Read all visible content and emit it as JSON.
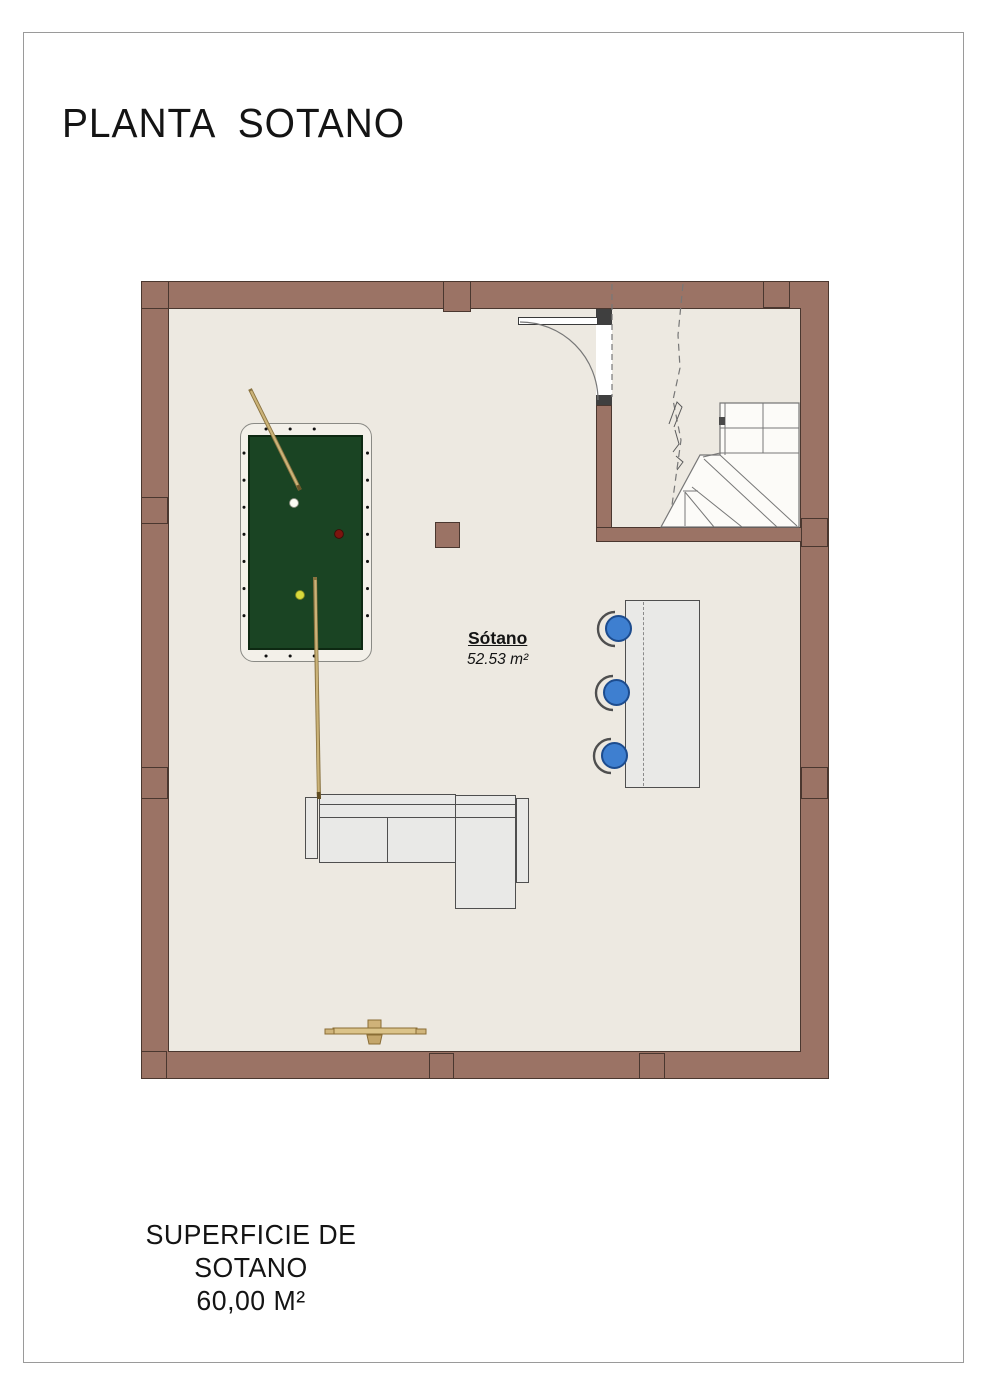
{
  "document": {
    "title": "PLANTA  SOTANO",
    "footer_line1": "SUPERFICIE DE SOTANO",
    "footer_line2": "60,00 M²"
  },
  "room": {
    "name": "Sótano",
    "area_label": "52.53 m²"
  },
  "drawn_elements": [
    "exterior-walls",
    "wall-pilasters",
    "stair-enclosure",
    "door",
    "winder-staircase",
    "pool-table",
    "cue-sticks",
    "billiard-balls",
    "bar-counter",
    "bar-stools",
    "sectional-sofa",
    "support-column",
    "cue-rack"
  ],
  "colors": {
    "wall": "#9b7365",
    "wall_outline": "#4a372f",
    "floor": "#ede9e1",
    "pool_felt": "#1a4423",
    "pool_frame": "#f3f0e9",
    "stool_blue": "#3e7fd0",
    "furniture_gray": "#e9e9e7",
    "cue_wood": "#c6ad72",
    "door_jamb": "#3f3f3f",
    "ball_red": "#7c150f",
    "ball_yellow": "#d9da3a",
    "ball_white": "#fbfbf2"
  }
}
